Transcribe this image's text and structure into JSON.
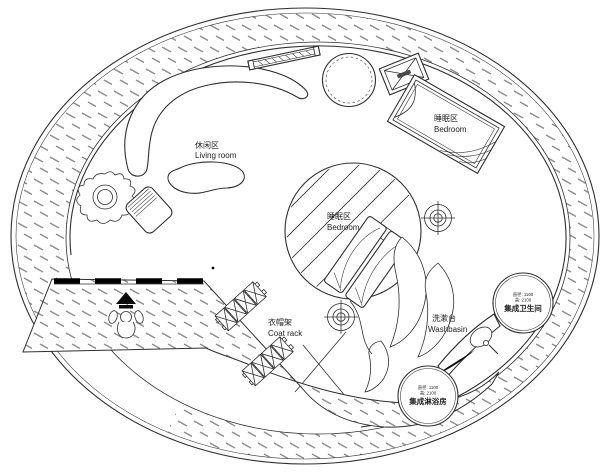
{
  "plan_labels": {
    "living_room_zh": "休闲区",
    "living_room_en": "Living room",
    "bedroom_upper_zh": "睡眠区",
    "bedroom_upper_en": "Bedroom",
    "bedroom_center_zh": "睡眠区",
    "bedroom_center_en": "Bedroom",
    "coat_rack_zh": "衣帽架",
    "coat_rack_en": "Coat rack",
    "washbasin_zh": "洗漱台",
    "washbasin_en": "Washbasin",
    "bathroom_pod_name": "集成卫生间",
    "bathroom_pod_dim1": "直径: 1100",
    "bathroom_pod_dim2": "高: 2100",
    "shower_pod_name": "集成淋浴房",
    "shower_pod_dim1": "直径: 1100",
    "shower_pod_dim2": "高: 2100"
  },
  "colors": {
    "ink": "#2f2f2f",
    "hatch": "#8d8d8d",
    "wall_fill": "#000000",
    "background": "#ffffff"
  }
}
